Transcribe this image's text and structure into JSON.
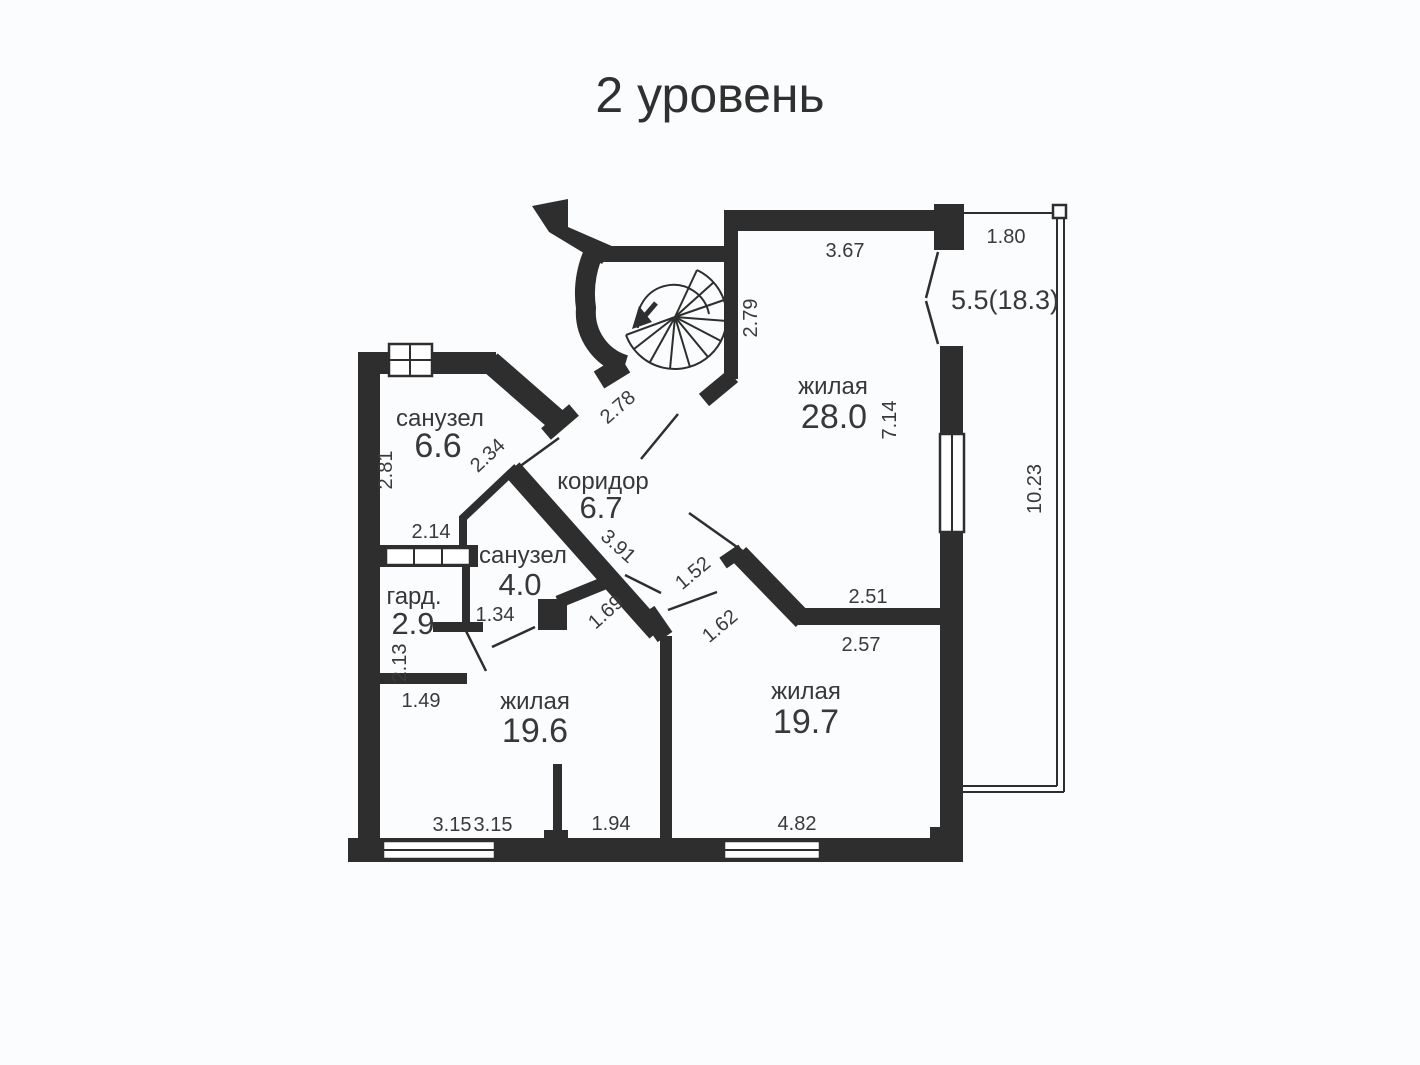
{
  "title": "2 уровень",
  "rooms": {
    "living28": {
      "name": "жилая",
      "area": "28.0"
    },
    "living196": {
      "name": "жилая",
      "area": "19.6"
    },
    "living197": {
      "name": "жилая",
      "area": "19.7"
    },
    "corridor": {
      "name": "коридор",
      "area": "6.7"
    },
    "bath66": {
      "name": "санузел",
      "area": "6.6"
    },
    "bath40": {
      "name": "санузел",
      "area": "4.0"
    },
    "wardrobe": {
      "name": "гард.",
      "area": "2.9"
    },
    "balcony": {
      "area": "5.5(18.3)"
    }
  },
  "dimensions": {
    "top_367": "3.67",
    "top_180": "1.80",
    "v_279": "2.79",
    "v_714": "7.14",
    "v_1023": "10.23",
    "diag_278": "2.78",
    "diag_234": "2.34",
    "v_281": "2.81",
    "h_214": "2.14",
    "diag_391": "3.91",
    "h_134": "1.34",
    "v_213": "2.13",
    "h_149": "1.49",
    "diag_169": "1.69",
    "diag_152": "1.52",
    "diag_162": "1.62",
    "h_251": "2.51",
    "h_257": "2.57",
    "h_315a": "3.15",
    "h_315b": "3.15",
    "h_194": "1.94",
    "h_482": "4.82"
  },
  "colors": {
    "wall": "#2e2e2e",
    "background": "#fbfcfd",
    "label": "#3a3a3a"
  }
}
